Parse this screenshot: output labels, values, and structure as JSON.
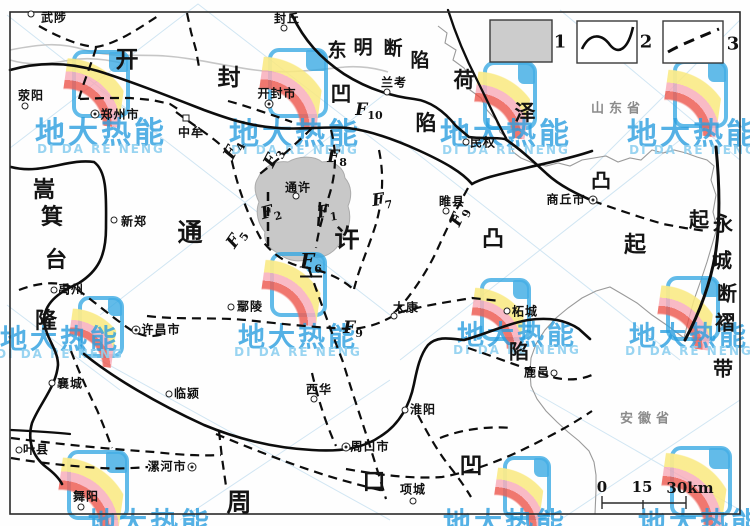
{
  "colors": {
    "accent_blue": "#2b9fe0",
    "fault_black": "#0d0d0d",
    "shaded_fill": "#c8c8c8",
    "boundary_gray": "#9a9a9a",
    "river_gray": "#c6c6c6"
  },
  "legend": {
    "items": [
      {
        "num": "1",
        "symbol": "shaded-area"
      },
      {
        "num": "2",
        "symbol": "solid-fault-line"
      },
      {
        "num": "3",
        "symbol": "dashed-fault-line"
      }
    ]
  },
  "scalebar": {
    "labels": [
      {
        "t": "0",
        "x": 602,
        "y": 487
      },
      {
        "t": "15",
        "x": 642,
        "y": 487
      },
      {
        "t": "30km",
        "x": 690,
        "y": 488
      }
    ]
  },
  "provinces": [
    {
      "name": "山东省",
      "x": 618,
      "y": 107
    },
    {
      "name": "安徽省",
      "x": 647,
      "y": 417
    }
  ],
  "region_labels": [
    {
      "id": "kaifeng-depression",
      "chars": [
        {
          "t": "开",
          "x": 127,
          "y": 57,
          "s": 23
        },
        {
          "t": "封",
          "x": 229,
          "y": 75,
          "s": 23
        },
        {
          "t": "凹",
          "x": 341,
          "y": 93,
          "s": 21
        },
        {
          "t": "陷",
          "x": 426,
          "y": 122,
          "s": 21
        }
      ]
    },
    {
      "id": "dongming-fault-depression",
      "chars": [
        {
          "t": "东",
          "x": 337,
          "y": 49,
          "s": 19
        },
        {
          "t": "明",
          "x": 363,
          "y": 46,
          "s": 19
        },
        {
          "t": "断",
          "x": 393,
          "y": 47,
          "s": 19
        },
        {
          "t": "陷",
          "x": 420,
          "y": 59,
          "s": 19
        }
      ]
    },
    {
      "id": "heze-uplift",
      "chars": [
        {
          "t": "荷",
          "x": 464,
          "y": 79,
          "s": 21
        },
        {
          "t": "泽",
          "x": 525,
          "y": 112,
          "s": 21
        },
        {
          "t": "凸",
          "x": 601,
          "y": 179,
          "s": 20
        },
        {
          "t": "起",
          "x": 699,
          "y": 218,
          "s": 20
        }
      ]
    },
    {
      "id": "tongxu-uplift",
      "chars": [
        {
          "t": "通",
          "x": 190,
          "y": 231,
          "s": 25
        },
        {
          "t": "许",
          "x": 347,
          "y": 237,
          "s": 25
        },
        {
          "t": "凸",
          "x": 493,
          "y": 237,
          "s": 22
        },
        {
          "t": "起",
          "x": 635,
          "y": 243,
          "s": 22
        }
      ]
    },
    {
      "id": "songji-platform-rise",
      "chars": [
        {
          "t": "嵩",
          "x": 44,
          "y": 188,
          "s": 22
        },
        {
          "t": "箕",
          "x": 52,
          "y": 215,
          "s": 22
        },
        {
          "t": "台",
          "x": 56,
          "y": 258,
          "s": 22
        },
        {
          "t": "隆",
          "x": 46,
          "y": 319,
          "s": 22
        }
      ]
    },
    {
      "id": "yongcheng-fault-fold-belt",
      "chars": [
        {
          "t": "永",
          "x": 723,
          "y": 222,
          "s": 20
        },
        {
          "t": "城",
          "x": 722,
          "y": 259,
          "s": 20
        },
        {
          "t": "断",
          "x": 727,
          "y": 292,
          "s": 20
        },
        {
          "t": "褶",
          "x": 725,
          "y": 321,
          "s": 20
        },
        {
          "t": "带",
          "x": 723,
          "y": 367,
          "s": 20
        }
      ]
    },
    {
      "id": "zhoukou-depression",
      "chars": [
        {
          "t": "周",
          "x": 239,
          "y": 501,
          "s": 25
        },
        {
          "t": "口",
          "x": 374,
          "y": 479,
          "s": 23
        },
        {
          "t": "凹",
          "x": 471,
          "y": 463,
          "s": 23
        },
        {
          "t": "陷",
          "x": 519,
          "y": 350,
          "s": 20
        }
      ]
    }
  ],
  "fault_labels": [
    {
      "main": "F",
      "sub": "1",
      "x": 327,
      "y": 213,
      "rot": -8,
      "emph": false
    },
    {
      "main": "F",
      "sub": "2",
      "x": 271,
      "y": 213,
      "rot": -15,
      "emph": false
    },
    {
      "main": "F",
      "sub": "3",
      "x": 274,
      "y": 158,
      "rot": -62,
      "emph": false
    },
    {
      "main": "F",
      "sub": "4",
      "x": 234,
      "y": 150,
      "rot": -62,
      "emph": false
    },
    {
      "main": "F",
      "sub": "5",
      "x": 237,
      "y": 239,
      "rot": -55,
      "emph": false
    },
    {
      "main": "F",
      "sub": "6",
      "x": 311,
      "y": 263,
      "rot": 0,
      "emph": true
    },
    {
      "main": "F",
      "sub": "7",
      "x": 382,
      "y": 201,
      "rot": -8,
      "emph": false
    },
    {
      "main": "F",
      "sub": "8",
      "x": 337,
      "y": 158,
      "rot": 0,
      "emph": false
    },
    {
      "main": "F",
      "sub": "9",
      "x": 460,
      "y": 217,
      "rot": -65,
      "emph": false
    },
    {
      "main": "F",
      "sub": "9",
      "x": 353,
      "y": 329,
      "rot": 0,
      "emph": false
    },
    {
      "main": "F",
      "sub": "10",
      "x": 369,
      "y": 111,
      "rot": 0,
      "emph": false
    }
  ],
  "cities": [
    {
      "name": "武陟",
      "mx": 31,
      "my": 14,
      "tx": 54,
      "ty": 17,
      "type": "c"
    },
    {
      "name": "封丘",
      "mx": 284,
      "my": 28,
      "tx": 287,
      "ty": 18,
      "type": "c"
    },
    {
      "name": "荥阳",
      "mx": 25,
      "my": 106,
      "tx": 31,
      "ty": 95,
      "type": "c"
    },
    {
      "name": "郑州市",
      "mx": 95,
      "my": 114,
      "tx": 120,
      "ty": 114,
      "type": "d"
    },
    {
      "name": "中牟",
      "mx": 186,
      "my": 118,
      "tx": 191,
      "ty": 132,
      "type": "s"
    },
    {
      "name": "开封市",
      "mx": 269,
      "my": 104,
      "tx": 277,
      "ty": 93,
      "type": "d"
    },
    {
      "name": "兰考",
      "mx": 387,
      "my": 92,
      "tx": 394,
      "ty": 82,
      "type": "c"
    },
    {
      "name": "民权",
      "mx": 466,
      "my": 142,
      "tx": 483,
      "ty": 142,
      "type": "c"
    },
    {
      "name": "商丘市",
      "mx": 593,
      "my": 200,
      "tx": 566,
      "ty": 199,
      "type": "d"
    },
    {
      "name": "睢县",
      "mx": 446,
      "my": 211,
      "tx": 452,
      "ty": 201,
      "type": "c"
    },
    {
      "name": "新郑",
      "mx": 114,
      "my": 220,
      "tx": 134,
      "ty": 221,
      "type": "c"
    },
    {
      "name": "通许",
      "mx": 296,
      "my": 196,
      "tx": 298,
      "ty": 187,
      "type": "c"
    },
    {
      "name": "禹州",
      "mx": 54,
      "my": 290,
      "tx": 71,
      "ty": 289,
      "type": "c"
    },
    {
      "name": "许昌市",
      "mx": 136,
      "my": 330,
      "tx": 161,
      "ty": 329,
      "type": "d"
    },
    {
      "name": "鄢陵",
      "mx": 231,
      "my": 307,
      "tx": 250,
      "ty": 306,
      "type": "c"
    },
    {
      "name": "太康",
      "mx": 394,
      "my": 316,
      "tx": 406,
      "ty": 307,
      "type": "c"
    },
    {
      "name": "柘城",
      "mx": 507,
      "my": 311,
      "tx": 525,
      "ty": 311,
      "type": "c"
    },
    {
      "name": "鹿邑",
      "mx": 554,
      "my": 373,
      "tx": 537,
      "ty": 372,
      "type": "c"
    },
    {
      "name": "襄城",
      "mx": 52,
      "my": 383,
      "tx": 70,
      "ty": 383,
      "type": "c"
    },
    {
      "name": "临颍",
      "mx": 169,
      "my": 394,
      "tx": 187,
      "ty": 393,
      "type": "c"
    },
    {
      "name": "叶县",
      "mx": 19,
      "my": 450,
      "tx": 36,
      "ty": 449,
      "type": "c"
    },
    {
      "name": "漯河市",
      "mx": 192,
      "my": 467,
      "tx": 167,
      "ty": 466,
      "type": "d"
    },
    {
      "name": "西华",
      "mx": 314,
      "my": 399,
      "tx": 319,
      "ty": 389,
      "type": "c"
    },
    {
      "name": "淮阳",
      "mx": 405,
      "my": 410,
      "tx": 423,
      "ty": 409,
      "type": "c"
    },
    {
      "name": "周口市",
      "mx": 346,
      "my": 447,
      "tx": 370,
      "ty": 446,
      "type": "d"
    },
    {
      "name": "项城",
      "mx": 413,
      "my": 501,
      "tx": 413,
      "ty": 489,
      "type": "c"
    },
    {
      "name": "舞阳",
      "mx": 81,
      "my": 507,
      "tx": 86,
      "ty": 496,
      "type": "c"
    }
  ],
  "watermark": {
    "text": "地大热能",
    "subtext": "DI DA RE NENG",
    "texts": [
      {
        "x": 101,
        "y": 130,
        "s": 30
      },
      {
        "x": 295,
        "y": 131,
        "s": 30
      },
      {
        "x": 506,
        "y": 131,
        "s": 30
      },
      {
        "x": 693,
        "y": 131,
        "s": 30
      },
      {
        "x": 60,
        "y": 337,
        "s": 27
      },
      {
        "x": 298,
        "y": 335,
        "s": 27
      },
      {
        "x": 517,
        "y": 333,
        "s": 27
      },
      {
        "x": 689,
        "y": 334,
        "s": 27
      },
      {
        "x": 150,
        "y": 521,
        "s": 28
      },
      {
        "x": 505,
        "y": 521,
        "s": 28
      },
      {
        "x": 700,
        "y": 521,
        "s": 28
      }
    ],
    "logos": [
      {
        "x": 72,
        "y": 50,
        "w": 50,
        "h": 60
      },
      {
        "x": 268,
        "y": 48,
        "w": 52,
        "h": 62
      },
      {
        "x": 483,
        "y": 61,
        "w": 46,
        "h": 61
      },
      {
        "x": 673,
        "y": 60,
        "w": 47,
        "h": 60
      },
      {
        "x": 78,
        "y": 296,
        "w": 38,
        "h": 54
      },
      {
        "x": 270,
        "y": 252,
        "w": 49,
        "h": 57
      },
      {
        "x": 480,
        "y": 278,
        "w": 43,
        "h": 55
      },
      {
        "x": 666,
        "y": 276,
        "w": 46,
        "h": 57
      },
      {
        "x": 67,
        "y": 450,
        "w": 54,
        "h": 62
      },
      {
        "x": 503,
        "y": 456,
        "w": 40,
        "h": 56
      },
      {
        "x": 670,
        "y": 446,
        "w": 54,
        "h": 63
      }
    ]
  }
}
